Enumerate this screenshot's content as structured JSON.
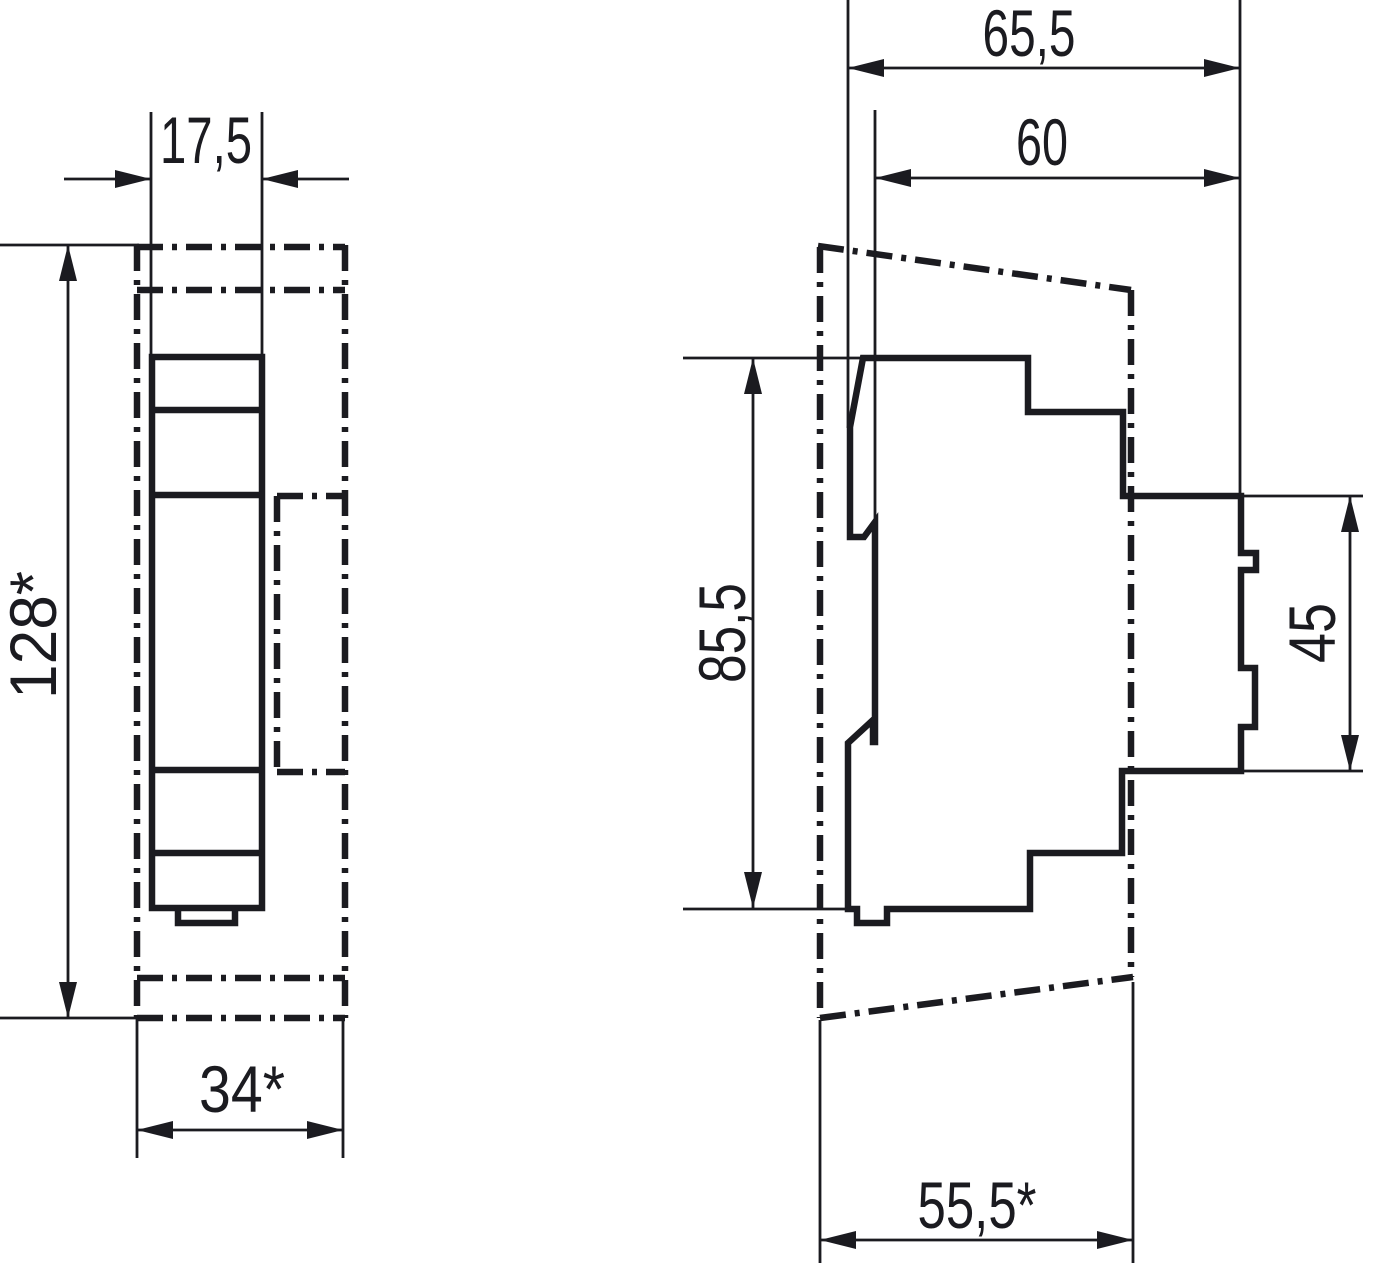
{
  "drawing": {
    "type": "technical-dimension-drawing",
    "views": {
      "front": {
        "width_label": "17,5",
        "height_label": "128*",
        "mount_width_label": "34*"
      },
      "side": {
        "total_depth_label": "65,5",
        "body_depth_label": "60",
        "body_height_label": "85,5",
        "terminal_height_label": "45",
        "mount_depth_label": "55,5*"
      }
    }
  },
  "colors": {
    "line": "#1b1b20",
    "background": "#ffffff"
  }
}
